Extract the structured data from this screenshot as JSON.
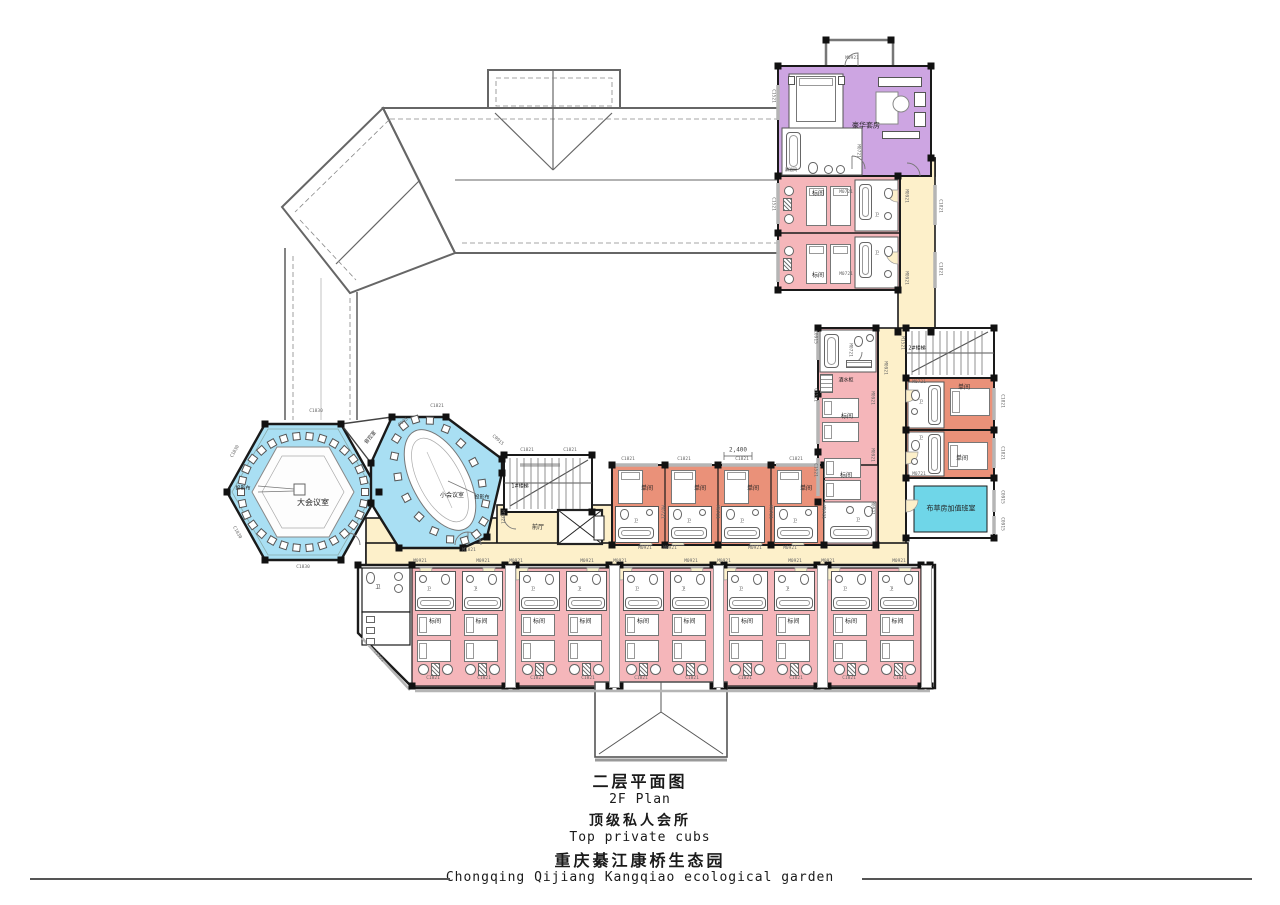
{
  "title_block": {
    "plan_title_zh": "二层平面图",
    "plan_title_en": "2F Plan",
    "subtitle_zh": "顶级私人会所",
    "subtitle_en": "Top private cubs",
    "project_zh": "重庆綦江康桥生态园",
    "project_en": "Chongqing Qijiang Kangqiao ecological garden"
  },
  "colors": {
    "suite": "#cda5e2",
    "standard_room": "#f5b6ba",
    "single_room": "#ea9179",
    "corridor": "#fdf0ca",
    "meeting_room": "#a9dff3",
    "linen_room": "#6fd6e8",
    "wall": "#1a1a1a"
  },
  "wc_label": "卫",
  "dimension": {
    "text": "2,400",
    "x": 738,
    "y": 450
  },
  "bottom_rooms": [
    "标间",
    "标间",
    "标间",
    "标间",
    "标间",
    "标间",
    "标间",
    "标间",
    "标间",
    "标间"
  ],
  "middle_rooms": [
    "单间",
    "单间",
    "单间",
    "单间"
  ],
  "room_labels": [
    {
      "t": "豪华套房",
      "x": 866,
      "y": 126,
      "s": 7
    },
    {
      "t": "淋浴间",
      "x": 791,
      "y": 170,
      "s": 4
    },
    {
      "t": "标间",
      "x": 818,
      "y": 194,
      "s": 6
    },
    {
      "t": "标间",
      "x": 818,
      "y": 276,
      "s": 6
    },
    {
      "t": "酒水柜",
      "x": 846,
      "y": 381,
      "s": 5
    },
    {
      "t": "标间",
      "x": 847,
      "y": 417,
      "s": 6
    },
    {
      "t": "标间",
      "x": 846,
      "y": 476,
      "s": 6
    },
    {
      "t": "卫",
      "x": 858,
      "y": 520,
      "s": 4
    },
    {
      "t": "单间",
      "x": 964,
      "y": 388,
      "s": 6
    },
    {
      "t": "单间",
      "x": 962,
      "y": 459,
      "s": 6
    },
    {
      "t": "卫",
      "x": 921,
      "y": 402,
      "s": 4
    },
    {
      "t": "卫",
      "x": 921,
      "y": 438,
      "s": 4
    },
    {
      "t": "卫",
      "x": 877,
      "y": 215,
      "s": 4
    },
    {
      "t": "卫",
      "x": 877,
      "y": 253,
      "s": 4
    },
    {
      "t": "布草房加值班室",
      "x": 951,
      "y": 509,
      "s": 7
    },
    {
      "t": "2#楼梯",
      "x": 917,
      "y": 349,
      "s": 5
    },
    {
      "t": "1#楼梯",
      "x": 520,
      "y": 487,
      "s": 5
    },
    {
      "t": "前厅",
      "x": 538,
      "y": 528,
      "s": 6
    },
    {
      "t": "大会议室",
      "x": 313,
      "y": 503,
      "s": 8
    },
    {
      "t": "投影布",
      "x": 243,
      "y": 489,
      "s": 5
    },
    {
      "t": "小会议室",
      "x": 452,
      "y": 496,
      "s": 6
    },
    {
      "t": "投影布",
      "x": 482,
      "y": 498,
      "s": 5
    },
    {
      "t": "音控室",
      "x": 371,
      "y": 438,
      "s": 5,
      "r": -50
    },
    {
      "t": "卫",
      "x": 378,
      "y": 588,
      "s": 5
    }
  ],
  "codes": [
    {
      "t": "M0921",
      "x": 852,
      "y": 59,
      "r": 0
    },
    {
      "t": "M0721",
      "x": 857,
      "y": 151,
      "r": 90
    },
    {
      "t": "C1521",
      "x": 772,
      "y": 96,
      "r": 90
    },
    {
      "t": "C1521",
      "x": 772,
      "y": 204,
      "r": 90
    },
    {
      "t": "M0721",
      "x": 846,
      "y": 193,
      "r": 0
    },
    {
      "t": "M0921",
      "x": 905,
      "y": 196,
      "r": 90
    },
    {
      "t": "M0721",
      "x": 846,
      "y": 275,
      "r": 0
    },
    {
      "t": "M0921",
      "x": 905,
      "y": 278,
      "r": 90
    },
    {
      "t": "C1821",
      "x": 939,
      "y": 206,
      "r": 90
    },
    {
      "t": "C1821",
      "x": 939,
      "y": 269,
      "r": 90
    },
    {
      "t": "C0915",
      "x": 814,
      "y": 337,
      "r": 90
    },
    {
      "t": "M0721",
      "x": 849,
      "y": 350,
      "r": 90
    },
    {
      "t": "M0921",
      "x": 884,
      "y": 368,
      "r": 90
    },
    {
      "t": "C1521",
      "x": 814,
      "y": 395,
      "r": 90
    },
    {
      "t": "C1521",
      "x": 814,
      "y": 470,
      "r": 90
    },
    {
      "t": "M1521",
      "x": 901,
      "y": 343,
      "r": 90
    },
    {
      "t": "M0721",
      "x": 919,
      "y": 383,
      "r": 0
    },
    {
      "t": "M0721",
      "x": 919,
      "y": 475,
      "r": 0
    },
    {
      "t": "C1821",
      "x": 1001,
      "y": 401,
      "r": 90
    },
    {
      "t": "C1821",
      "x": 1001,
      "y": 453,
      "r": 90
    },
    {
      "t": "C0915",
      "x": 1001,
      "y": 497,
      "r": 90
    },
    {
      "t": "C0915",
      "x": 1001,
      "y": 524,
      "r": 90
    },
    {
      "t": "M0921",
      "x": 871,
      "y": 398,
      "r": 90
    },
    {
      "t": "M0921",
      "x": 871,
      "y": 455,
      "r": 90
    },
    {
      "t": "M0921",
      "x": 871,
      "y": 508,
      "r": 90
    },
    {
      "t": "C1830",
      "x": 316,
      "y": 412,
      "r": 0
    },
    {
      "t": "C1821",
      "x": 527,
      "y": 451,
      "r": 0
    },
    {
      "t": "C1821",
      "x": 570,
      "y": 451,
      "r": 0
    },
    {
      "t": "C1821",
      "x": 628,
      "y": 460,
      "r": 0
    },
    {
      "t": "C1821",
      "x": 684,
      "y": 460,
      "r": 0
    },
    {
      "t": "C1821",
      "x": 742,
      "y": 460,
      "r": 0
    },
    {
      "t": "C1821",
      "x": 796,
      "y": 460,
      "r": 0
    },
    {
      "t": "M1521",
      "x": 501,
      "y": 517,
      "r": 90
    },
    {
      "t": "M0921",
      "x": 645,
      "y": 549,
      "r": 0
    },
    {
      "t": "M0921",
      "x": 670,
      "y": 549,
      "r": 0
    },
    {
      "t": "M0921",
      "x": 755,
      "y": 549,
      "r": 0
    },
    {
      "t": "M0921",
      "x": 790,
      "y": 549,
      "r": 0
    },
    {
      "t": "M0721",
      "x": 661,
      "y": 512,
      "r": 90
    },
    {
      "t": "M0721",
      "x": 716,
      "y": 512,
      "r": 90
    },
    {
      "t": "M0721",
      "x": 769,
      "y": 512,
      "r": 90
    },
    {
      "t": "M0721",
      "x": 822,
      "y": 512,
      "r": 90
    },
    {
      "t": "M0921",
      "x": 420,
      "y": 562,
      "r": 0
    },
    {
      "t": "M0921",
      "x": 483,
      "y": 562,
      "r": 0
    },
    {
      "t": "M0921",
      "x": 516,
      "y": 562,
      "r": 0
    },
    {
      "t": "M0921",
      "x": 587,
      "y": 562,
      "r": 0
    },
    {
      "t": "M0921",
      "x": 620,
      "y": 562,
      "r": 0
    },
    {
      "t": "M0921",
      "x": 691,
      "y": 562,
      "r": 0
    },
    {
      "t": "M0921",
      "x": 724,
      "y": 562,
      "r": 0
    },
    {
      "t": "M0921",
      "x": 795,
      "y": 562,
      "r": 0
    },
    {
      "t": "M0921",
      "x": 828,
      "y": 562,
      "r": 0
    },
    {
      "t": "M0921",
      "x": 899,
      "y": 562,
      "r": 0
    },
    {
      "t": "C1821",
      "x": 433,
      "y": 679,
      "r": 0
    },
    {
      "t": "C1821",
      "x": 484,
      "y": 679,
      "r": 0
    },
    {
      "t": "C1821",
      "x": 537,
      "y": 679,
      "r": 0
    },
    {
      "t": "C1821",
      "x": 588,
      "y": 679,
      "r": 0
    },
    {
      "t": "C1821",
      "x": 641,
      "y": 679,
      "r": 0
    },
    {
      "t": "C1821",
      "x": 692,
      "y": 679,
      "r": 0
    },
    {
      "t": "C1821",
      "x": 745,
      "y": 679,
      "r": 0
    },
    {
      "t": "C1821",
      "x": 796,
      "y": 679,
      "r": 0
    },
    {
      "t": "C1821",
      "x": 849,
      "y": 679,
      "r": 0
    },
    {
      "t": "C1821",
      "x": 900,
      "y": 679,
      "r": 0
    },
    {
      "t": "C1521",
      "x": 378,
      "y": 657,
      "r": 51
    },
    {
      "t": "C1830",
      "x": 303,
      "y": 568,
      "r": 0
    },
    {
      "t": "C1830",
      "x": 236,
      "y": 452,
      "r": -61
    },
    {
      "t": "C1830",
      "x": 236,
      "y": 533,
      "r": 61
    },
    {
      "t": "C1821",
      "x": 437,
      "y": 407,
      "r": 0
    },
    {
      "t": "D005",
      "x": 404,
      "y": 423,
      "r": -38
    },
    {
      "t": "C0915",
      "x": 497,
      "y": 441,
      "r": 41
    },
    {
      "t": "M1821",
      "x": 469,
      "y": 551,
      "r": 0
    }
  ]
}
